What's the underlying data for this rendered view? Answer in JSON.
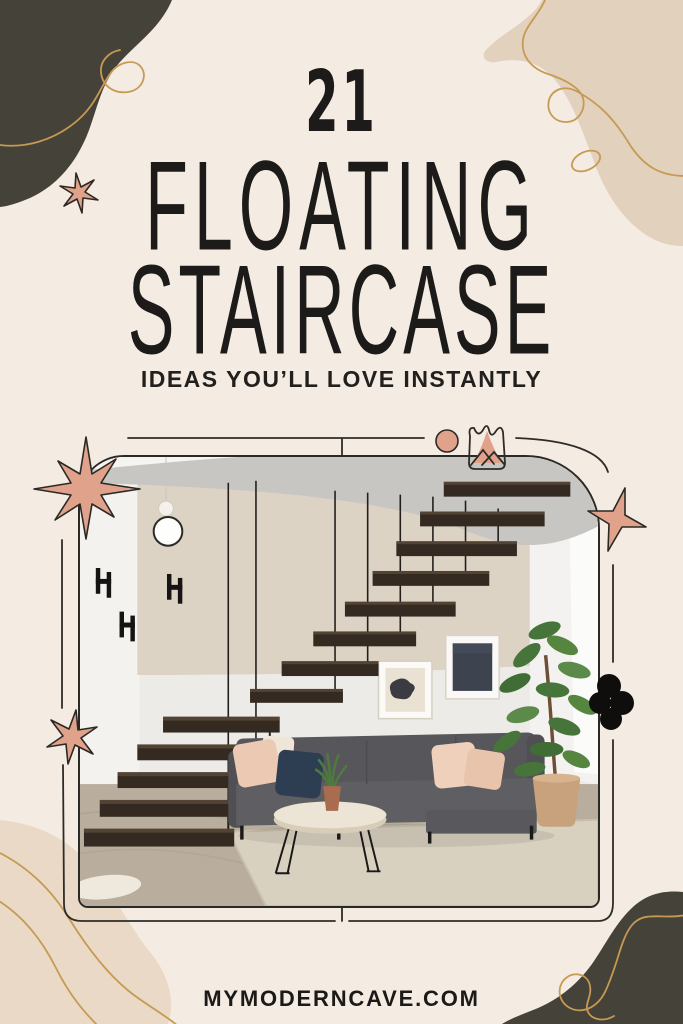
{
  "pin": {
    "count": "21",
    "title_line1": "FLOATING",
    "title_line2": "STAIRCASE",
    "subtitle": "IDEAS YOU’LL LOVE INSTANTLY",
    "website": "MYMODERNCAVE.COM"
  },
  "photo_alt": "Modern floating staircase with dark espresso wood treads suspended from thin black rods, above a charcoal sectional sofa with blush and navy pillows, round cream coffee table with potted snake plant, fiddle-leaf fig in tan planter, two framed abstract prints and a beige rug",
  "palette": {
    "background": "#f4ebe2",
    "ink": "#1c1b19",
    "blob_charcoal": "#454239",
    "blob_beige": "#e2d1bd",
    "accent_pink": "#e0a28b",
    "gold": "#c69a52"
  }
}
